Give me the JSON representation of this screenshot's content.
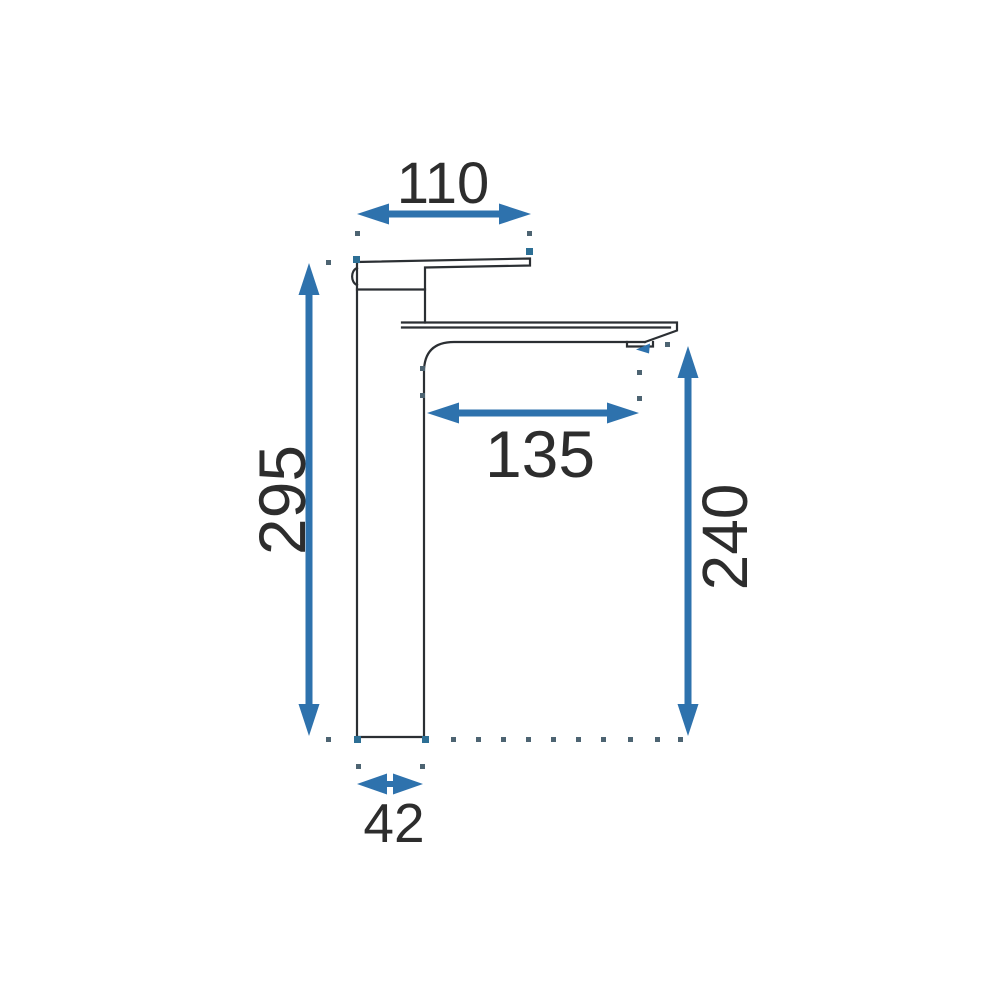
{
  "colors": {
    "accent": "#2e72ad",
    "line": "#2b2f33",
    "ink": "#2d2d2d",
    "dot": "#4d6472",
    "marker": "#2d6f95"
  },
  "drawing": {
    "type": "technical-dimension-drawing",
    "labels": {
      "spout_top_width": "110",
      "total_height": "295",
      "spout_reach": "135",
      "spout_height": "240",
      "base_width": "42"
    }
  }
}
